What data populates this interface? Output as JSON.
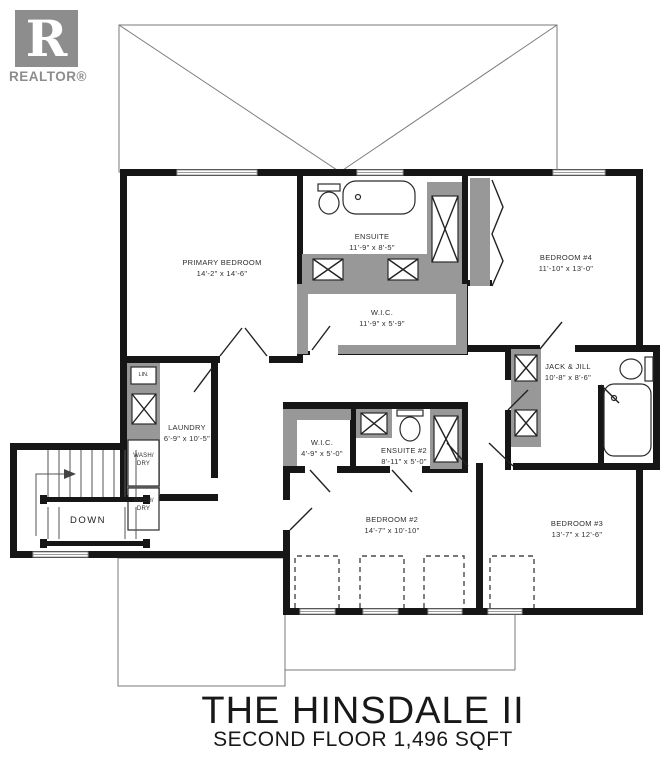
{
  "logo": {
    "letter": "R",
    "brand": "REALTOR®"
  },
  "rooms": [
    {
      "name": "PRIMARY BEDROOM",
      "dims": "14'-2\" x 14'-6\""
    },
    {
      "name": "ENSUITE",
      "dims": "11'-9\" x 8'-5\""
    },
    {
      "name": "BEDROOM #4",
      "dims": "11'-10\" x 13'-0\""
    },
    {
      "name": "W.I.C.",
      "dims": "11'-9\" x 5'-9\""
    },
    {
      "name": "JACK & JILL",
      "dims": "10'-8\" x 8'-6\""
    },
    {
      "name": "LAUNDRY",
      "dims": "6'-9\" x 10'-5\""
    },
    {
      "name": "W.I.C.",
      "dims": "4'-9\" x 5'-0\""
    },
    {
      "name": "ENSUITE #2",
      "dims": "8'-11\" x 5'-0\""
    },
    {
      "name": "BEDROOM #2",
      "dims": "14'-7\" x 10'-10\""
    },
    {
      "name": "BEDROOM #3",
      "dims": "13'-7\" x 12'-6\""
    }
  ],
  "stairs": {
    "label": "DOWN"
  },
  "laundry_fixtures": {
    "linen": "LIN.",
    "wash1_line1": "WASH/",
    "wash1_line2": "DRY",
    "wash2_line1": "WASH/",
    "wash2_line2": "DRY"
  },
  "title": {
    "main": "THE HINSDALE II",
    "subtitle": "SECOND FLOOR 1,496 SQFT"
  },
  "colors": {
    "wall": "#161616",
    "fixture_gray": "#989898",
    "roof_line": "#7a7a7a",
    "logo_gray": "#8d8d8d",
    "label_text": "#2e2e2e"
  }
}
